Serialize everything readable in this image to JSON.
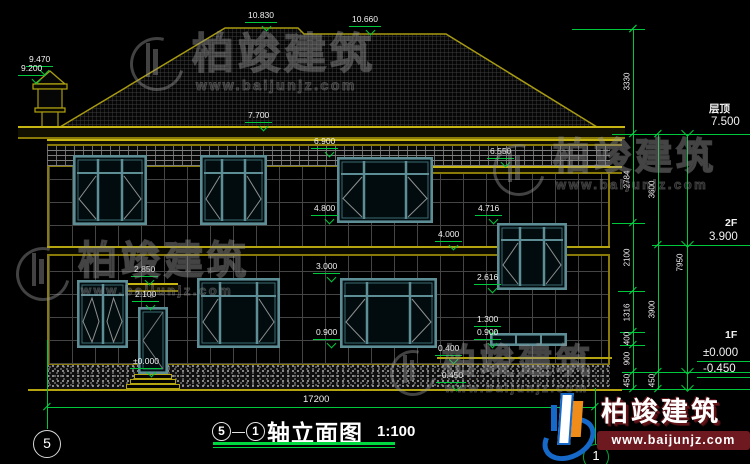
{
  "watermark": {
    "brand": "柏竣建筑",
    "url": "www.baijunjz.com"
  },
  "footer": {
    "brand": "柏竣建筑",
    "url": "www.baijunjz.com"
  },
  "title": {
    "axis_start": "5",
    "axis_end": "1",
    "separator": "—",
    "name": "轴立面图",
    "scale": "1:100"
  },
  "axes": {
    "left_bubble": "5",
    "right_bubble": "1"
  },
  "marks": {
    "chimney_top": "9.470",
    "chimney_cap": "9.200",
    "ridge_left": "10.830",
    "ridge_right": "10.660",
    "eave": "7.700",
    "f2_win_top": "6.900",
    "wing_eave": "6.550",
    "f2_win_sill": "4.800",
    "wing_win_top": "4.716",
    "belt": "4.000",
    "f1_win_top": "3.000",
    "wing_win_sill": "2.616",
    "canopy": "2.850",
    "door_head": "2.100",
    "strip_top": "1.300",
    "f1_win_sill": "0.900",
    "strip_sill": "0.900",
    "terrace": "0.400",
    "floor": "±0.000",
    "ground": "-0.450"
  },
  "levels": {
    "roof_name": "层顶",
    "roof": "7.500",
    "f2_name": "2F",
    "f2": "3.900",
    "f1_name": "1F",
    "f1_zero": "±0.000",
    "f1_ground": "-0.450"
  },
  "dims": {
    "chain_a": [
      "3330",
      "2784",
      "2100",
      "1316",
      "400",
      "900",
      "450"
    ],
    "chain_b": [
      "3600",
      "3900",
      "450"
    ],
    "total_height": "7950",
    "total_width": "17200"
  }
}
